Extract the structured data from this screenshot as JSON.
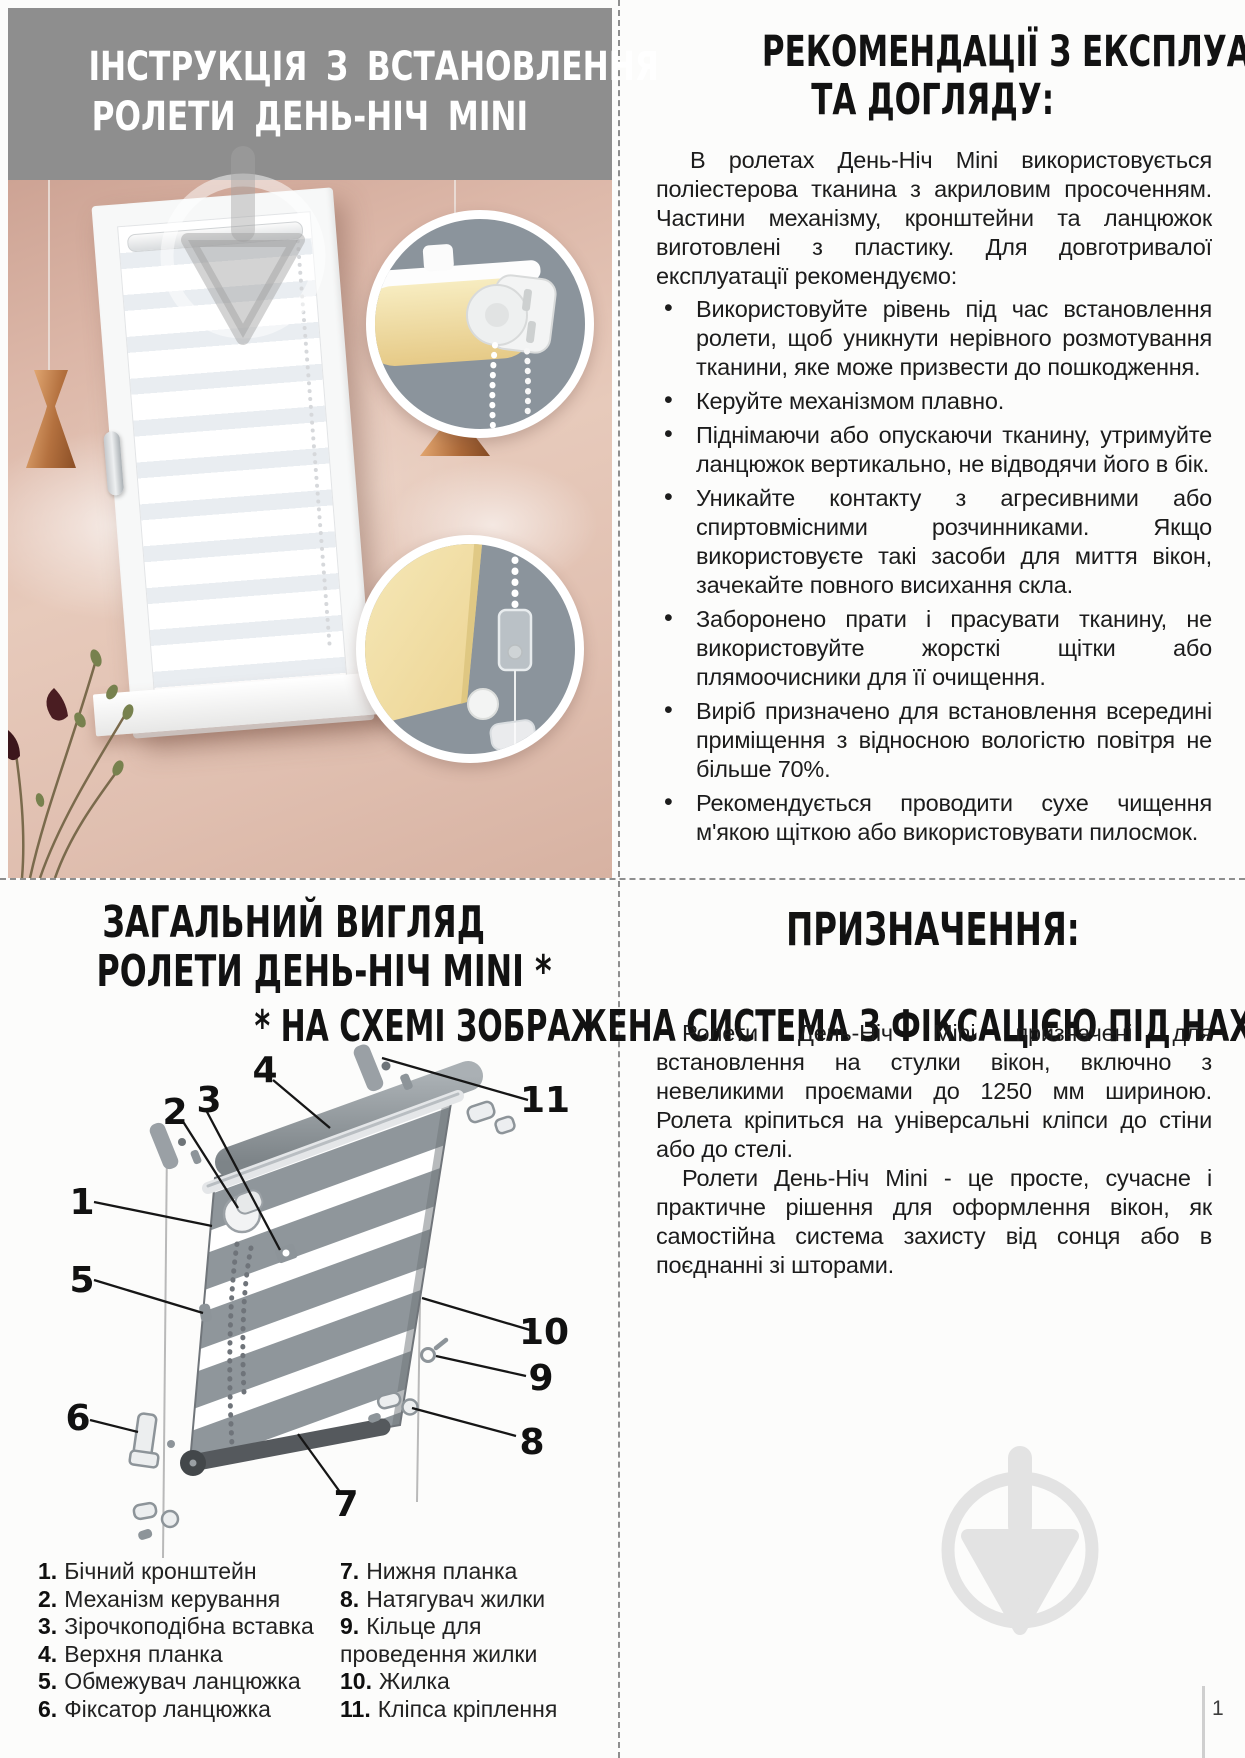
{
  "page": {
    "number": "1"
  },
  "colors": {
    "header_gray": "#8e8e8e",
    "inset_slate": "#8b949c",
    "wall_pink": "#dcb7a8",
    "fabric_yellow": "#f2e0a2",
    "copper": "#b4713f",
    "watermark_light": "#e4e4e4",
    "text": "#1b1b1b"
  },
  "icons": {
    "watermark": "plumb-logo-icon"
  },
  "install": {
    "title_line1": "ІНСТРУКЦІЯ З ВСТАНОВЛЕННЯ",
    "title_line2": "РОЛЕТИ ДЕНЬ-НІЧ MINI"
  },
  "care": {
    "title_line1": "РЕКОМЕНДАЦІЇ З ЕКСПЛУАТАЦІЇ",
    "title_line2": "ТА ДОГЛЯДУ:",
    "intro": "В ролетах День-Ніч Mini використовується поліестерова тканина з акриловим просоченням. Частини механізму, кронштейни та ланцюжок виготовлені з пластику. Для довготривалої експлуатації рекомендуємо:",
    "bullets": [
      "Використовуйте рівень під час встановлення ролети, щоб уникнути нерівного розмотування тканини, яке може призвести до пошкодження.",
      "Керуйте механізмом плавно.",
      "Піднімаючи або опускаючи тканину, утримуйте ланцюжок вертикально, не відводячи його в бік.",
      "Уникайте контакту з агресивними або спиртовмісними розчинниками. Якщо використовуєте такі засоби для миття вікон, зачекайте повного висихання скла.",
      "Заборонено прати і прасувати тканину, не використовуйте жорсткі щітки або плямоочисники для її очищення.",
      "Виріб призначено для встановлення всередині приміщення з відносною вологістю повітря не більше 70%.",
      "Рекомендується проводити сухе чищення м'якою щіткою або використовувати пилосмок."
    ]
  },
  "overview": {
    "title_line1": "ЗАГАЛЬНИЙ ВИГЛЯД",
    "title_line2": "РОЛЕТИ ДЕНЬ-НІЧ MINI *",
    "note": "* НА СХЕМІ ЗОБРАЖЕНА СИСТЕМА З ФІКСАЦІЄЮ ПІД НАХИЛ",
    "callouts": [
      "1",
      "2",
      "3",
      "4",
      "5",
      "6",
      "7",
      "8",
      "9",
      "10",
      "11"
    ],
    "parts_left": [
      {
        "num": "1.",
        "label": "Бічний кронштейн"
      },
      {
        "num": "2.",
        "label": "Механізм керування"
      },
      {
        "num": "3.",
        "label": "Зірочкоподібна вставка"
      },
      {
        "num": "4.",
        "label": "Верхня планка"
      },
      {
        "num": "5.",
        "label": "Обмежувач ланцюжка"
      },
      {
        "num": "6.",
        "label": "Фіксатор ланцюжка"
      }
    ],
    "parts_right": [
      {
        "num": "7.",
        "label": "Нижня планка"
      },
      {
        "num": "8.",
        "label": "Натягувач жилки"
      },
      {
        "num": "9.",
        "label": "Кільце для проведення жилки"
      },
      {
        "num": "10.",
        "label": "Жилка"
      },
      {
        "num": "11.",
        "label": "Кліпса кріплення"
      }
    ]
  },
  "purpose": {
    "title": "ПРИЗНАЧЕННЯ:",
    "p1": "Ролети День-Ніч Mini призначені для встановлення на стулки вікон, включно з невеликими проємами до 1250 мм шириною. Ролета кріпиться на універсальні кліпси до стіни або до стелі.",
    "p2": "Ролети День-Ніч Mini - це просте, сучасне і практичне рішення для оформлення вікон, як самостійна система захисту від сонця або в поєднанні зі шторами."
  }
}
